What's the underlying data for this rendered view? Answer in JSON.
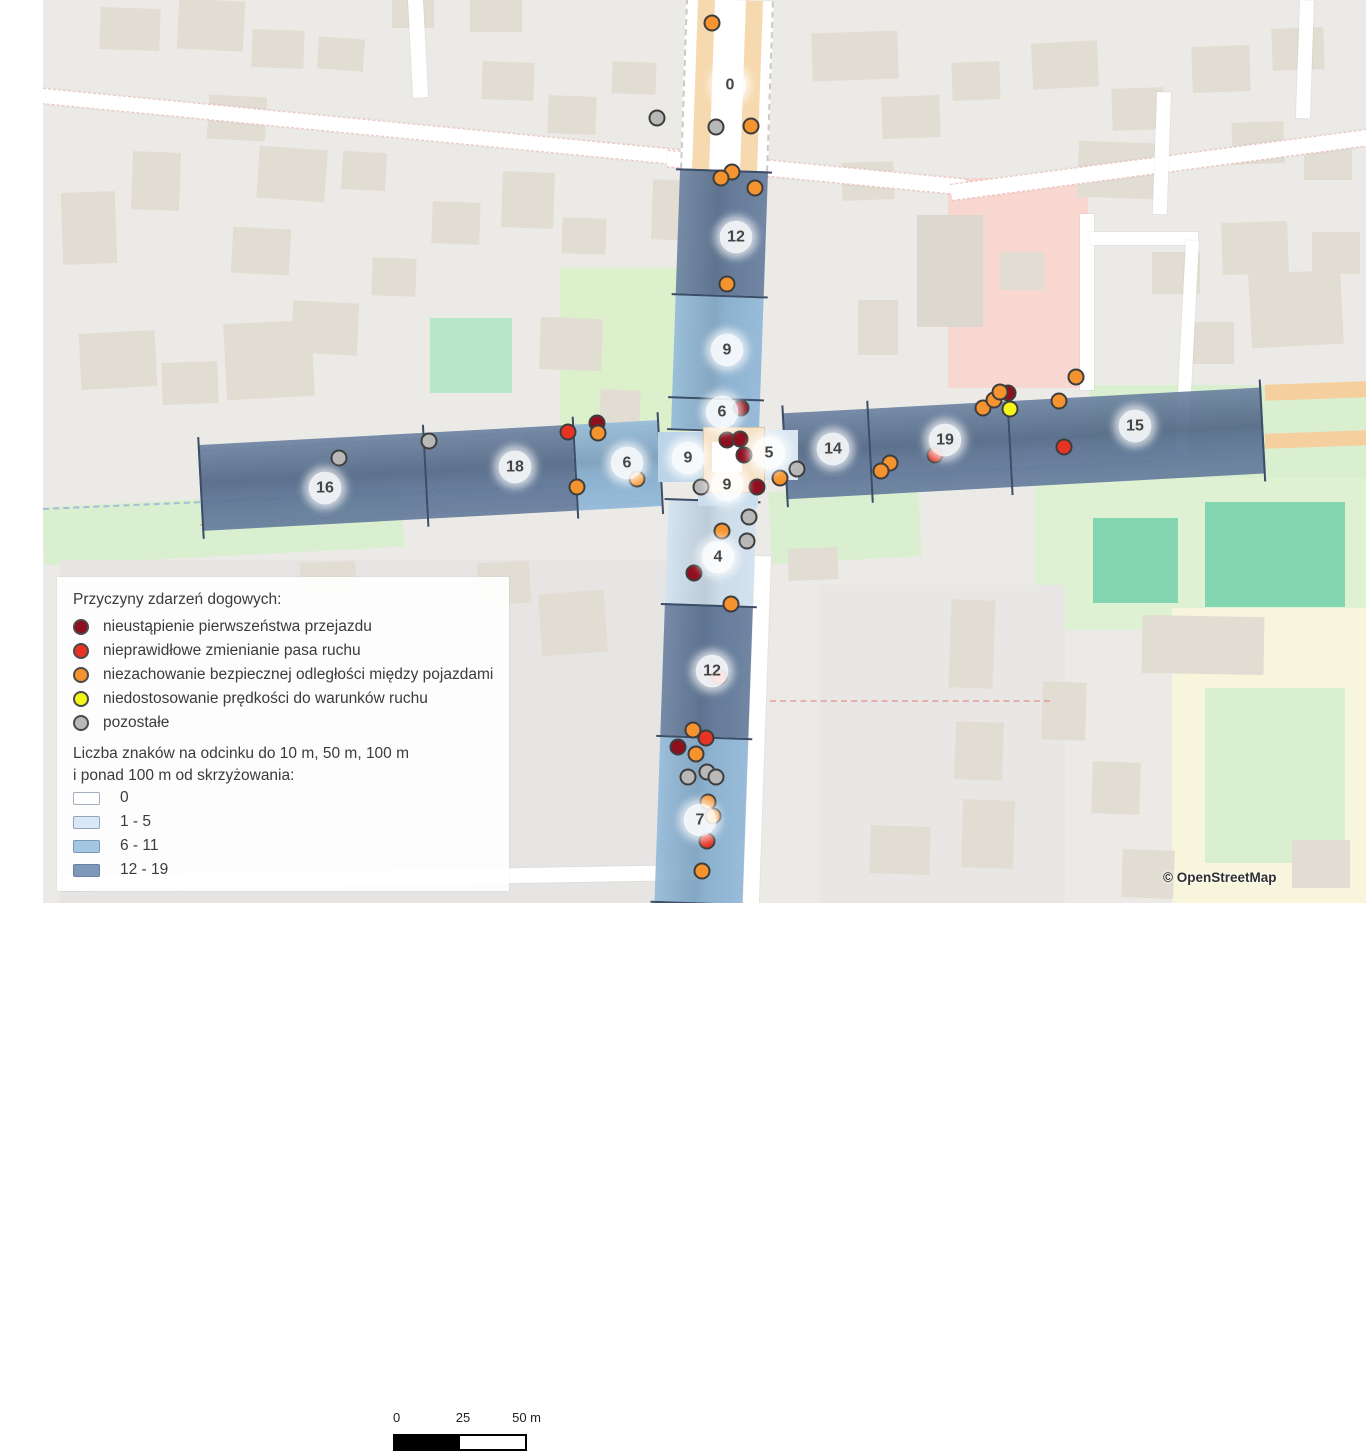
{
  "legend": {
    "title": "Przyczyny zdarzeń dogowych:",
    "causes": [
      {
        "id": "priority",
        "label": "nieustąpienie pierwszeństwa przejazdu",
        "color": "#8f0f1e"
      },
      {
        "id": "lane",
        "label": "nieprawidłowe zmienianie pasa ruchu",
        "color": "#e63323"
      },
      {
        "id": "distance",
        "label": "niezachowanie bezpiecznej odległości między pojazdami",
        "color": "#f5942e"
      },
      {
        "id": "speed",
        "label": "niedostosowanie prędkości do warunków ruchu",
        "color": "#f4f618"
      },
      {
        "id": "other",
        "label": "pozostałe",
        "color": "#b8b8b8"
      }
    ],
    "counts_title_line1": "Liczba znaków na odcinku do 10 m, 50 m, 100 m",
    "counts_title_line2": "i ponad 100 m od skrzyżowania:",
    "count_classes": [
      {
        "label": "0",
        "color": "#ffffff"
      },
      {
        "label": "1 - 5",
        "color": "#d9e8f4"
      },
      {
        "label": "6 - 11",
        "color": "#a3c7e2"
      },
      {
        "label": "12 - 19",
        "color": "#7e97ba"
      }
    ]
  },
  "scale_bar": {
    "ticks": [
      "0",
      "25",
      "50 m"
    ]
  },
  "attribution": "© OpenStreetMap",
  "map_data": {
    "class_colors": {
      "c0": "rgba(255,255,255,0.75)",
      "c1": "#cfe1f0",
      "c2": "#8ab4d6",
      "c3": "#5d7698"
    },
    "segment_badges": [
      {
        "value": "0",
        "x": 730,
        "y": 85
      },
      {
        "value": "12",
        "x": 736,
        "y": 237
      },
      {
        "value": "9",
        "x": 727,
        "y": 350
      },
      {
        "value": "6",
        "x": 722,
        "y": 412
      },
      {
        "value": "9",
        "x": 688,
        "y": 458
      },
      {
        "value": "5",
        "x": 769,
        "y": 453
      },
      {
        "value": "9",
        "x": 727,
        "y": 485
      },
      {
        "value": "14",
        "x": 833,
        "y": 449
      },
      {
        "value": "19",
        "x": 945,
        "y": 440
      },
      {
        "value": "15",
        "x": 1135,
        "y": 426
      },
      {
        "value": "16",
        "x": 325,
        "y": 488
      },
      {
        "value": "18",
        "x": 515,
        "y": 467
      },
      {
        "value": "6",
        "x": 627,
        "y": 463
      },
      {
        "value": "4",
        "x": 718,
        "y": 557
      },
      {
        "value": "12",
        "x": 712,
        "y": 671
      },
      {
        "value": "7",
        "x": 700,
        "y": 820
      }
    ],
    "incidents": [
      {
        "cause": "priority",
        "x": 741,
        "y": 408
      },
      {
        "cause": "priority",
        "x": 727,
        "y": 440
      },
      {
        "cause": "priority",
        "x": 740,
        "y": 439
      },
      {
        "cause": "priority",
        "x": 744,
        "y": 455
      },
      {
        "cause": "priority",
        "x": 757,
        "y": 487
      },
      {
        "cause": "priority",
        "x": 694,
        "y": 573
      },
      {
        "cause": "priority",
        "x": 678,
        "y": 747
      },
      {
        "cause": "priority",
        "x": 1008,
        "y": 393
      },
      {
        "cause": "priority",
        "x": 597,
        "y": 423
      },
      {
        "cause": "lane",
        "x": 568,
        "y": 432
      },
      {
        "cause": "lane",
        "x": 935,
        "y": 455
      },
      {
        "cause": "lane",
        "x": 1064,
        "y": 447
      },
      {
        "cause": "lane",
        "x": 719,
        "y": 677
      },
      {
        "cause": "lane",
        "x": 706,
        "y": 738
      },
      {
        "cause": "lane",
        "x": 707,
        "y": 841
      },
      {
        "cause": "distance",
        "x": 712,
        "y": 23
      },
      {
        "cause": "distance",
        "x": 751,
        "y": 126
      },
      {
        "cause": "distance",
        "x": 732,
        "y": 172
      },
      {
        "cause": "distance",
        "x": 721,
        "y": 178
      },
      {
        "cause": "distance",
        "x": 755,
        "y": 188
      },
      {
        "cause": "distance",
        "x": 727,
        "y": 284
      },
      {
        "cause": "distance",
        "x": 598,
        "y": 433
      },
      {
        "cause": "distance",
        "x": 577,
        "y": 487
      },
      {
        "cause": "distance",
        "x": 637,
        "y": 479
      },
      {
        "cause": "distance",
        "x": 780,
        "y": 478
      },
      {
        "cause": "distance",
        "x": 722,
        "y": 531
      },
      {
        "cause": "distance",
        "x": 731,
        "y": 604
      },
      {
        "cause": "distance",
        "x": 693,
        "y": 730
      },
      {
        "cause": "distance",
        "x": 696,
        "y": 754
      },
      {
        "cause": "distance",
        "x": 708,
        "y": 802
      },
      {
        "cause": "distance",
        "x": 713,
        "y": 816
      },
      {
        "cause": "distance",
        "x": 702,
        "y": 871
      },
      {
        "cause": "distance",
        "x": 890,
        "y": 463
      },
      {
        "cause": "distance",
        "x": 881,
        "y": 471
      },
      {
        "cause": "distance",
        "x": 983,
        "y": 408
      },
      {
        "cause": "distance",
        "x": 994,
        "y": 400
      },
      {
        "cause": "distance",
        "x": 1000,
        "y": 392
      },
      {
        "cause": "distance",
        "x": 1059,
        "y": 401
      },
      {
        "cause": "distance",
        "x": 1076,
        "y": 377
      },
      {
        "cause": "speed",
        "x": 1010,
        "y": 409
      },
      {
        "cause": "other",
        "x": 657,
        "y": 118
      },
      {
        "cause": "other",
        "x": 716,
        "y": 127
      },
      {
        "cause": "other",
        "x": 339,
        "y": 458
      },
      {
        "cause": "other",
        "x": 429,
        "y": 441
      },
      {
        "cause": "other",
        "x": 701,
        "y": 487
      },
      {
        "cause": "other",
        "x": 797,
        "y": 469
      },
      {
        "cause": "other",
        "x": 749,
        "y": 517
      },
      {
        "cause": "other",
        "x": 747,
        "y": 541
      },
      {
        "cause": "other",
        "x": 707,
        "y": 772
      },
      {
        "cause": "other",
        "x": 688,
        "y": 777
      },
      {
        "cause": "other",
        "x": 716,
        "y": 777
      }
    ]
  }
}
